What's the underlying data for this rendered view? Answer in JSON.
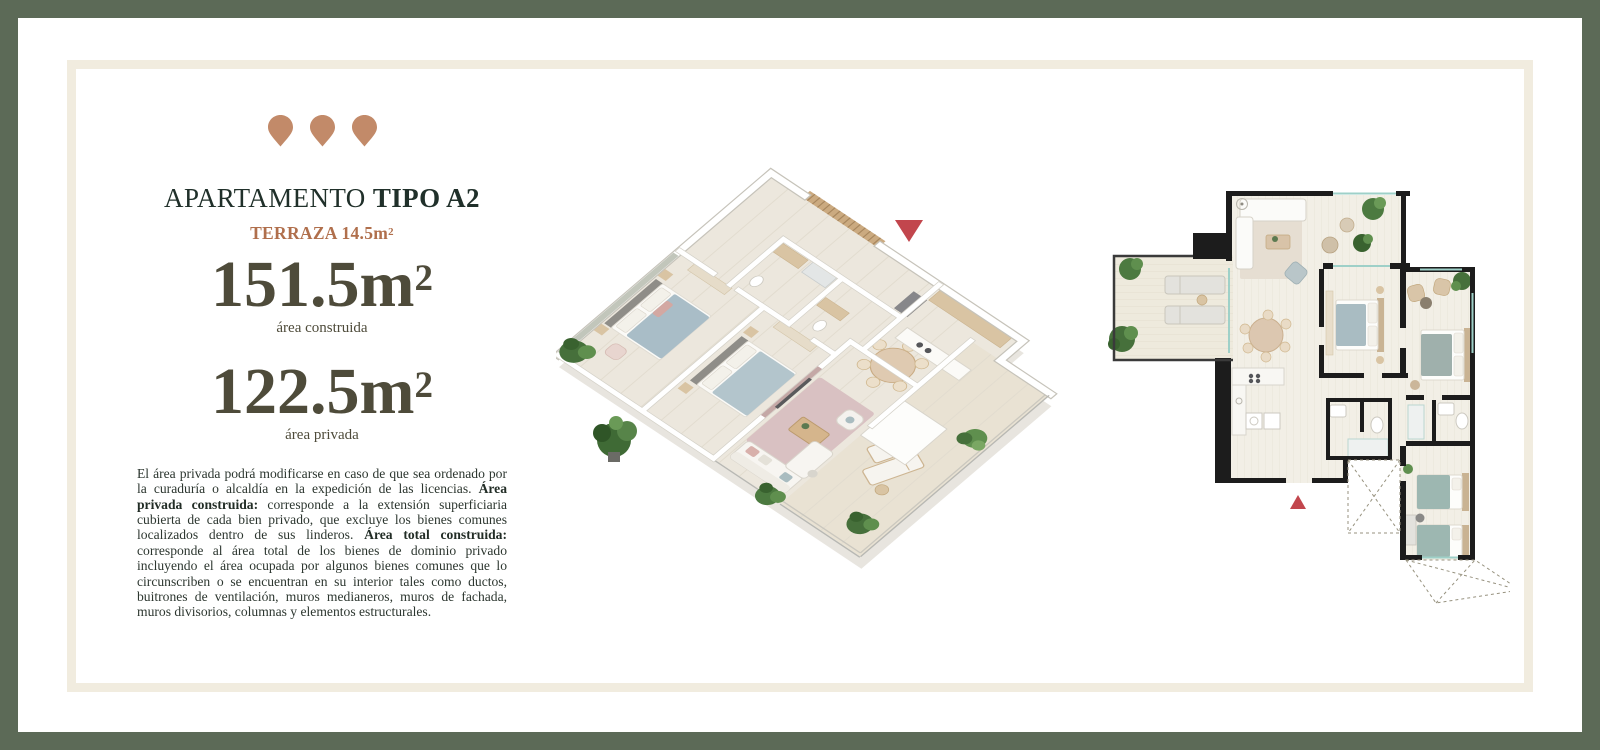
{
  "frame": {
    "outer_border_color": "#5c6a57",
    "inner_frame_color": "#f1ecdf",
    "background_color": "#ffffff"
  },
  "left_panel": {
    "pin_color": "#c28a69",
    "pin_icon": "location-pin-icon",
    "title_regular": "APARTAMENTO",
    "title_bold": "TIPO A2",
    "title_color": "#20302a",
    "terrace_label": "TERRAZA 14.5m",
    "terrace_sup": "2",
    "terrace_color": "#b06f4c",
    "metric_color": "#4e4b3a",
    "area_construida": {
      "value": "151.5m",
      "sup": "2",
      "label": "área construida"
    },
    "area_privada": {
      "value": "122.5m",
      "sup": "2",
      "label": "área privada"
    },
    "disclaimer": [
      {
        "text": "El área privada podrá modificarse en caso de que sea ordenado por la curaduría o alcaldía en la expedición de las licencias. ",
        "bold": false
      },
      {
        "text": "Área privada construida:",
        "bold": true
      },
      {
        "text": " corresponde a la extensión superficiaria cubierta de cada bien privado, que excluye los bienes comunes localizados dentro de sus linderos. ",
        "bold": false
      },
      {
        "text": "Área total construida:",
        "bold": true
      },
      {
        "text": " corresponde al área total de los bienes de dominio privado incluyendo el área ocupada por algunos bienes comunes que lo circunscriben o se encuentran en su interior tales como ductos, buitrones de ventilación, muros medianeros, muros de fachada, muros divisorios, columnas y elementos estructurales.",
        "bold": false
      }
    ]
  },
  "plans": {
    "marker_color": "#c2464d",
    "iso_plan_name": "apartment-3d-isometric-render",
    "flat_plan_name": "apartment-2d-floor-plan"
  }
}
